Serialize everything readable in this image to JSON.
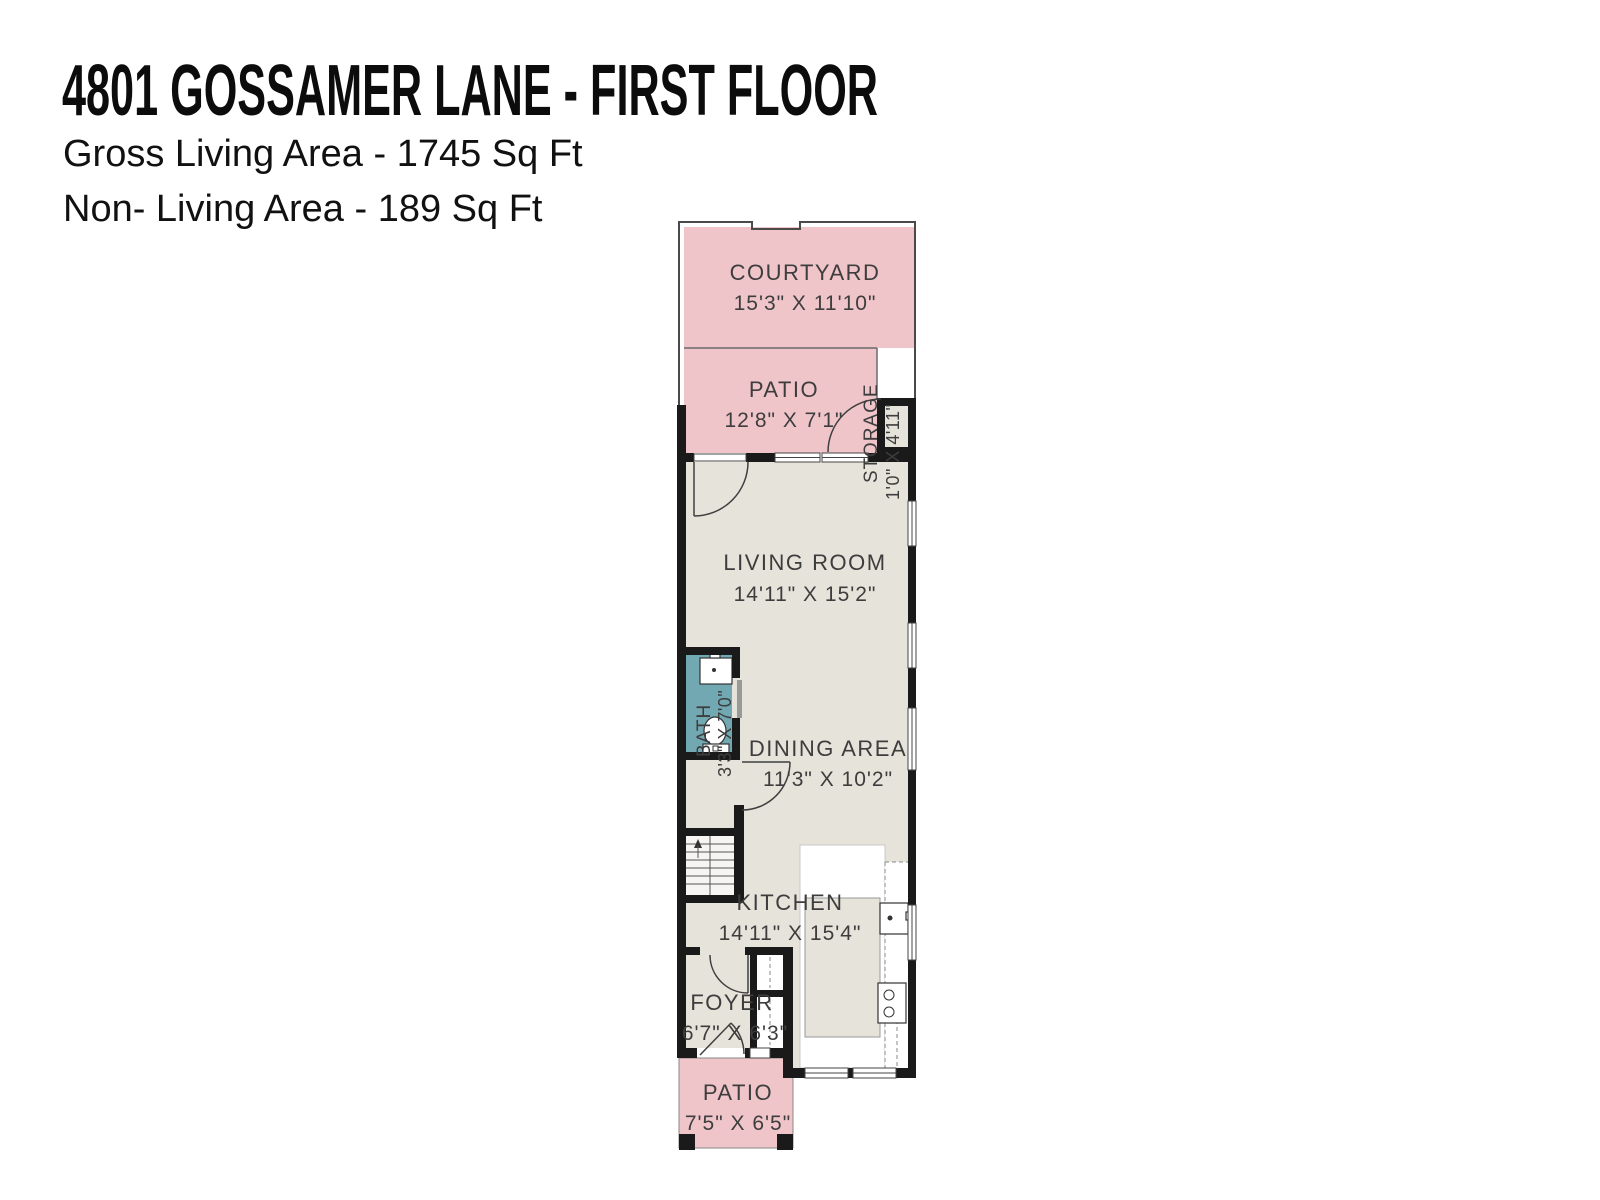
{
  "header": {
    "title": "4801 GOSSAMER LANE - FIRST FLOOR",
    "gross_living_area": "Gross Living Area - 1745 Sq Ft",
    "non_living_area": "Non- Living Area - 189 Sq Ft"
  },
  "rooms": {
    "courtyard": {
      "name": "COURTYARD",
      "dim": "15'3\" X 11'10\""
    },
    "patio_upper": {
      "name": "PATIO",
      "dim": "12'8\" X 7'1\""
    },
    "storage": {
      "name": "STORAGE",
      "dim": "1'0\" X 4'11\""
    },
    "living_room": {
      "name": "LIVING ROOM",
      "dim": "14'11\" X 15'2\""
    },
    "bath": {
      "name": "BATH",
      "dim": "3'3\" X 7'0\""
    },
    "dining_area": {
      "name": "DINING AREA",
      "dim": "11'3\" X 10'2\""
    },
    "kitchen": {
      "name": "KITCHEN",
      "dim": "14'11\" X 15'4\""
    },
    "foyer": {
      "name": "FOYER",
      "dim": "6'7\" X 6'3\""
    },
    "patio_lower": {
      "name": "PATIO",
      "dim": "7'5\" X 6'5\""
    }
  },
  "colors": {
    "outdoor_pink": "#efc5ca",
    "floor_beige": "#e6e3da",
    "bath_teal": "#72a8b2",
    "wall_black": "#1a1a1a",
    "label_gray": "#3d3d3d"
  }
}
